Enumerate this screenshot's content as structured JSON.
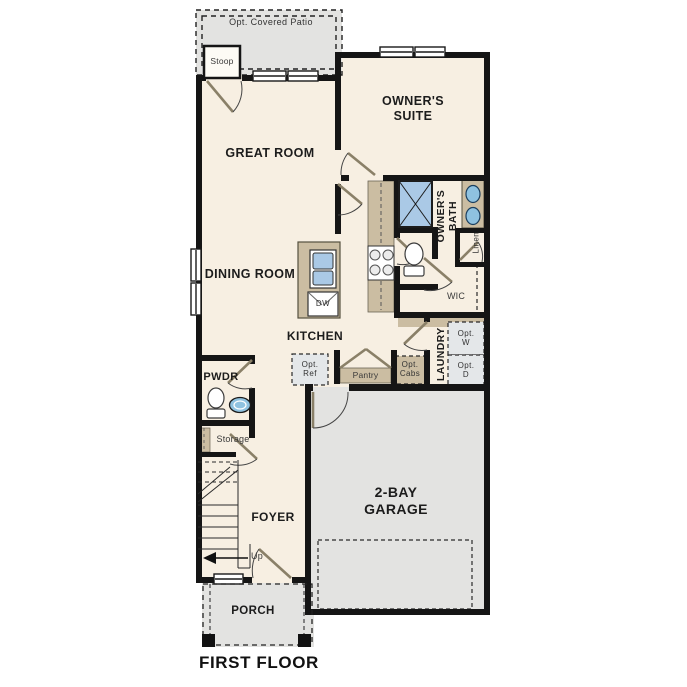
{
  "title": "FIRST FLOOR",
  "labels": {
    "patio": "Opt. Covered Patio",
    "stoop": "Stoop",
    "owners_suite": "OWNER'S SUITE",
    "great_room": "GREAT ROOM",
    "dining_room": "DINING ROOM",
    "kitchen": "KITCHEN",
    "owners_bath": "OWNER'S BATH",
    "linen": "Linen",
    "wic": "WIC",
    "laundry": "LAUNDRY",
    "opt_washer": "Opt. W",
    "opt_dryer": "Opt. D",
    "opt_ref": "Opt. Ref",
    "pantry": "Pantry",
    "opt_cabs": "Opt. Cabs",
    "pwdr": "PWDR",
    "storage": "Storage",
    "foyer": "FOYER",
    "up": "Up",
    "dishwasher": "DW",
    "garage": "2-BAY GARAGE",
    "porch": "PORCH"
  },
  "colors": {
    "wall": "#151515",
    "room": "#f7efe2",
    "gray": "#e3e3e1",
    "tan": "#cbbda2",
    "shower": "#aac9e6",
    "sink": "#8fc2e0",
    "optfill": "#e4e7e9"
  }
}
